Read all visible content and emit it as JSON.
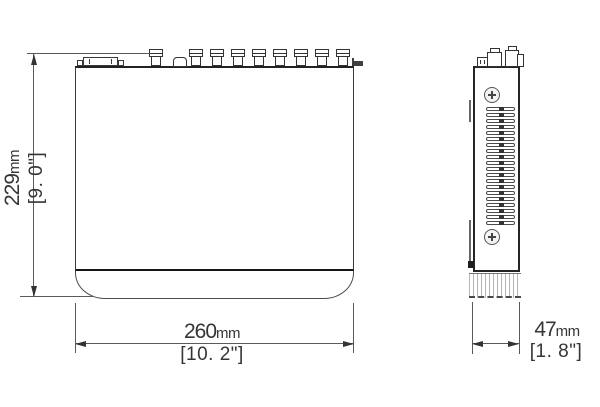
{
  "colors": {
    "background": "#ffffff",
    "thin_line": "#5a5a5a",
    "outline": "#3a3a3a",
    "thick_edge": "#161616",
    "text": "#353535"
  },
  "dimensions": {
    "height": {
      "value": "229",
      "unit": "mm",
      "imperial": "[9. 0\"]"
    },
    "width": {
      "value": "260",
      "unit": "mm",
      "imperial": "[10. 2\"]"
    },
    "depth": {
      "value": "47",
      "unit": "mm",
      "imperial": "[1. 8\"]"
    }
  },
  "repeats": {
    "bnc_ports": 8,
    "vent_slots": 20
  }
}
